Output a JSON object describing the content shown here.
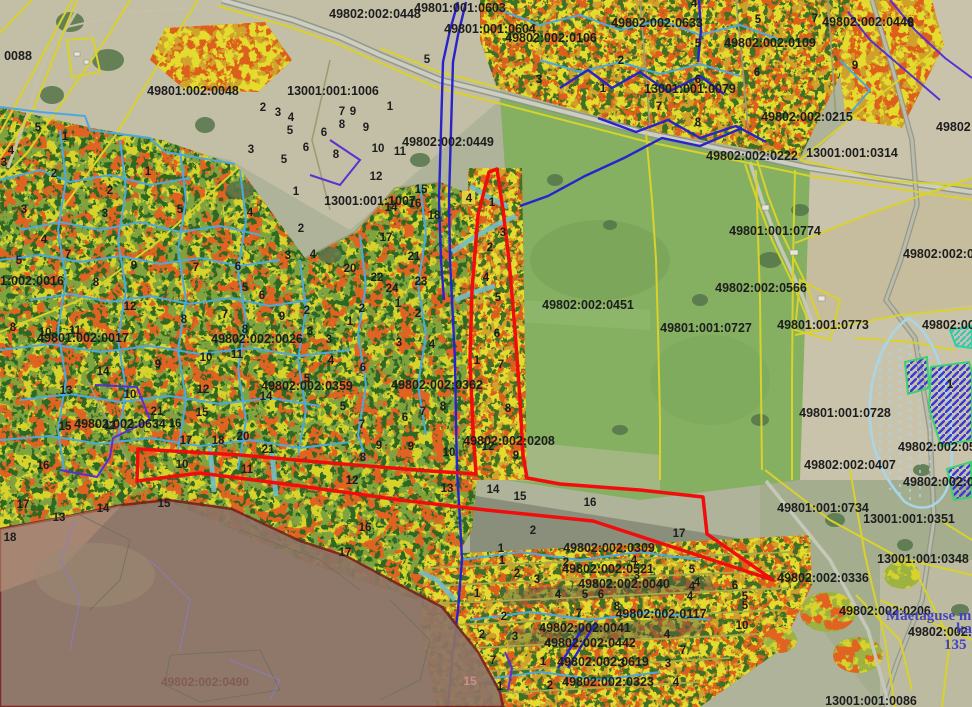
{
  "map": {
    "colors": {
      "selection_red": "#f20d0d",
      "overlay_brown": "#8d7366",
      "overlay_border": "#7a2121",
      "boundary_yellow": "#d8d22b",
      "boundary_cyan": "#4fa8dc",
      "stream_blue": "#2823cc",
      "boundary_purple": "#5b2fd4",
      "hatch_blue": "#3a3ad6",
      "hatch_border_green": "#3fd06f",
      "label_ink": "#1d1d1d",
      "place_blue": "#4343bf"
    },
    "parcel_labels": [
      {
        "t": "49801:001:0603",
        "x": 460,
        "y": 12
      },
      {
        "t": "49802:002:0448",
        "x": 375,
        "y": 18
      },
      {
        "t": "49801:001:0604",
        "x": 490,
        "y": 33
      },
      {
        "t": "49802:002:0106",
        "x": 551,
        "y": 42
      },
      {
        "t": "49802:002:0633",
        "x": 657,
        "y": 27
      },
      {
        "t": "49802:002:0109",
        "x": 770,
        "y": 47
      },
      {
        "t": "49802:002:0446",
        "x": 868,
        "y": 26
      },
      {
        "t": "0088",
        "x": 18,
        "y": 60
      },
      {
        "t": "49801:002:0048",
        "x": 193,
        "y": 95
      },
      {
        "t": "13001:001:1006",
        "x": 333,
        "y": 95
      },
      {
        "t": "13001:001:0079",
        "x": 690,
        "y": 93
      },
      {
        "t": "49802:0",
        "x": 936,
        "y": 131,
        "a": "s"
      },
      {
        "t": "49802:002:0449",
        "x": 448,
        "y": 146
      },
      {
        "t": "49802:002:0215",
        "x": 807,
        "y": 121
      },
      {
        "t": "13001:001:0314",
        "x": 852,
        "y": 157
      },
      {
        "t": "49802:002:0222",
        "x": 752,
        "y": 160
      },
      {
        "t": "13001:001:1007",
        "x": 370,
        "y": 205
      },
      {
        "t": "49801:001:0774",
        "x": 775,
        "y": 235
      },
      {
        "t": "49802:002:0374",
        "x": 903,
        "y": 258,
        "a": "s"
      },
      {
        "t": "1:002:0016",
        "x": 0,
        "y": 285,
        "a": "s"
      },
      {
        "t": "49801:002:0017",
        "x": 83,
        "y": 342
      },
      {
        "t": "49802:002:0026",
        "x": 257,
        "y": 343
      },
      {
        "t": "49802:002:0451",
        "x": 588,
        "y": 309
      },
      {
        "t": "49802:002:0566",
        "x": 761,
        "y": 292
      },
      {
        "t": "49801:001:0727",
        "x": 706,
        "y": 332
      },
      {
        "t": "49801:001:0773",
        "x": 823,
        "y": 329
      },
      {
        "t": "49802:002:0",
        "x": 922,
        "y": 329,
        "a": "s"
      },
      {
        "t": "49802:002:0359",
        "x": 307,
        "y": 390
      },
      {
        "t": "49802:002:0362",
        "x": 437,
        "y": 389
      },
      {
        "t": "49801:001:0728",
        "x": 845,
        "y": 417
      },
      {
        "t": "49802:002:0634",
        "x": 120,
        "y": 428
      },
      {
        "t": "49802:002:0208",
        "x": 509,
        "y": 445
      },
      {
        "t": "49802:002:0570",
        "x": 898,
        "y": 451,
        "a": "s"
      },
      {
        "t": "49802:002:0407",
        "x": 850,
        "y": 469
      },
      {
        "t": "49802:002:0222",
        "x": 903,
        "y": 486,
        "a": "s"
      },
      {
        "t": "49801:001:0734",
        "x": 823,
        "y": 512
      },
      {
        "t": "13001:001:0351",
        "x": 909,
        "y": 523
      },
      {
        "t": "13001:001:0348",
        "x": 923,
        "y": 563
      },
      {
        "t": "49802:002:0336",
        "x": 823,
        "y": 582
      },
      {
        "t": "49802:002:0309",
        "x": 609,
        "y": 552
      },
      {
        "t": "49802:002:0521",
        "x": 608,
        "y": 573
      },
      {
        "t": "49802:002:0040",
        "x": 624,
        "y": 588
      },
      {
        "t": "49802:002:0117",
        "x": 661,
        "y": 618
      },
      {
        "t": "49802:002:0041",
        "x": 585,
        "y": 632
      },
      {
        "t": "49802:002:0442",
        "x": 590,
        "y": 647
      },
      {
        "t": "49802:002:0619",
        "x": 603,
        "y": 666
      },
      {
        "t": "49802:002:0323",
        "x": 608,
        "y": 686
      },
      {
        "t": "49802:002:0206",
        "x": 885,
        "y": 615
      },
      {
        "t": "49802:002:020",
        "x": 908,
        "y": 636,
        "a": "s"
      },
      {
        "t": "13001:001:0086",
        "x": 871,
        "y": 705
      }
    ],
    "overlay_label": {
      "t": "49802:002:0490",
      "x": 205,
      "y": 686
    },
    "pink_label": {
      "t": "15",
      "x": 470,
      "y": 685
    },
    "marker_box": {
      "t": "4",
      "x": 469,
      "y": 202
    },
    "place_text": [
      {
        "t": "Mäetaguse m",
        "x": 886,
        "y": 620,
        "a": "s"
      },
      {
        "t": "ka",
        "x": 956,
        "y": 633,
        "a": "s"
      },
      {
        "t": "135",
        "x": 944,
        "y": 649,
        "a": "s"
      }
    ],
    "unit_numbers": [
      [
        38,
        131,
        "5"
      ],
      [
        65,
        140,
        "1"
      ],
      [
        11,
        154,
        "4"
      ],
      [
        4,
        166,
        "3"
      ],
      [
        54,
        177,
        "2"
      ],
      [
        110,
        194,
        "2"
      ],
      [
        24,
        213,
        "3"
      ],
      [
        105,
        217,
        "3"
      ],
      [
        180,
        213,
        "5"
      ],
      [
        148,
        175,
        "1"
      ],
      [
        250,
        216,
        "4"
      ],
      [
        296,
        195,
        "1"
      ],
      [
        301,
        232,
        "2"
      ],
      [
        263,
        111,
        "2"
      ],
      [
        278,
        116,
        "3"
      ],
      [
        291,
        121,
        "4"
      ],
      [
        290,
        134,
        "5"
      ],
      [
        251,
        153,
        "3"
      ],
      [
        284,
        163,
        "5"
      ],
      [
        306,
        151,
        "6"
      ],
      [
        324,
        136,
        "6"
      ],
      [
        342,
        128,
        "8"
      ],
      [
        336,
        158,
        "8"
      ],
      [
        342,
        115,
        "7"
      ],
      [
        353,
        115,
        "9"
      ],
      [
        366,
        131,
        "9"
      ],
      [
        378,
        152,
        "10"
      ],
      [
        400,
        155,
        "11"
      ],
      [
        376,
        180,
        "12"
      ],
      [
        390,
        110,
        "1"
      ],
      [
        421,
        193,
        "15"
      ],
      [
        415,
        207,
        "16"
      ],
      [
        391,
        211,
        "14"
      ],
      [
        386,
        241,
        "17"
      ],
      [
        434,
        219,
        "18"
      ],
      [
        427,
        63,
        "5"
      ],
      [
        694,
        7,
        "4"
      ],
      [
        758,
        23,
        "5"
      ],
      [
        815,
        22,
        "7"
      ],
      [
        911,
        27,
        "8"
      ],
      [
        539,
        83,
        "3"
      ],
      [
        621,
        64,
        "2"
      ],
      [
        603,
        92,
        "1"
      ],
      [
        698,
        47,
        "5"
      ],
      [
        698,
        83,
        "6"
      ],
      [
        757,
        76,
        "6"
      ],
      [
        659,
        110,
        "7"
      ],
      [
        698,
        126,
        "8"
      ],
      [
        855,
        69,
        "9"
      ],
      [
        19,
        264,
        "5"
      ],
      [
        44,
        243,
        "4"
      ],
      [
        68,
        258,
        "7"
      ],
      [
        134,
        269,
        "9"
      ],
      [
        96,
        286,
        "8"
      ],
      [
        196,
        271,
        "7"
      ],
      [
        238,
        270,
        "6"
      ],
      [
        288,
        259,
        "3"
      ],
      [
        313,
        258,
        "4"
      ],
      [
        245,
        291,
        "5"
      ],
      [
        262,
        299,
        "6"
      ],
      [
        130,
        310,
        "12"
      ],
      [
        184,
        323,
        "8"
      ],
      [
        225,
        318,
        "7"
      ],
      [
        282,
        320,
        "9"
      ],
      [
        13,
        331,
        "8"
      ],
      [
        45,
        336,
        "10"
      ],
      [
        75,
        334,
        "11"
      ],
      [
        245,
        333,
        "8"
      ],
      [
        307,
        314,
        "2"
      ],
      [
        310,
        335,
        "3"
      ],
      [
        329,
        343,
        "3"
      ],
      [
        362,
        312,
        "2"
      ],
      [
        350,
        325,
        "1"
      ],
      [
        398,
        307,
        "1"
      ],
      [
        418,
        317,
        "2"
      ],
      [
        432,
        348,
        "4"
      ],
      [
        350,
        272,
        "20"
      ],
      [
        414,
        260,
        "21"
      ],
      [
        377,
        281,
        "22"
      ],
      [
        421,
        285,
        "23"
      ],
      [
        392,
        292,
        "24"
      ],
      [
        158,
        368,
        "9"
      ],
      [
        237,
        358,
        "11"
      ],
      [
        206,
        361,
        "10"
      ],
      [
        203,
        393,
        "12"
      ],
      [
        103,
        375,
        "14"
      ],
      [
        266,
        400,
        "14"
      ],
      [
        66,
        394,
        "13"
      ],
      [
        130,
        398,
        "10"
      ],
      [
        202,
        416,
        "15"
      ],
      [
        157,
        415,
        "21"
      ],
      [
        175,
        427,
        "16"
      ],
      [
        186,
        444,
        "17"
      ],
      [
        218,
        444,
        "18"
      ],
      [
        243,
        440,
        "20"
      ],
      [
        268,
        453,
        "21"
      ],
      [
        65,
        430,
        "15"
      ],
      [
        110,
        429,
        "11"
      ],
      [
        43,
        469,
        "16"
      ],
      [
        343,
        410,
        "5"
      ],
      [
        362,
        428,
        "7"
      ],
      [
        423,
        415,
        "7"
      ],
      [
        405,
        421,
        "6"
      ],
      [
        443,
        410,
        "8"
      ],
      [
        399,
        346,
        "3"
      ],
      [
        363,
        371,
        "6"
      ],
      [
        331,
        364,
        "4"
      ],
      [
        307,
        382,
        "5"
      ],
      [
        379,
        449,
        "9"
      ],
      [
        411,
        450,
        "9"
      ],
      [
        449,
        456,
        "10"
      ],
      [
        363,
        461,
        "8"
      ],
      [
        477,
        364,
        "1"
      ],
      [
        488,
        450,
        "12"
      ],
      [
        492,
        206,
        "1"
      ],
      [
        503,
        236,
        "3"
      ],
      [
        490,
        251,
        "2"
      ],
      [
        486,
        281,
        "4"
      ],
      [
        498,
        301,
        "5"
      ],
      [
        497,
        337,
        "6"
      ],
      [
        501,
        368,
        "7"
      ],
      [
        508,
        412,
        "8"
      ],
      [
        516,
        459,
        "9"
      ],
      [
        182,
        468,
        "10"
      ],
      [
        247,
        473,
        "11"
      ],
      [
        447,
        492,
        "13"
      ],
      [
        493,
        493,
        "14"
      ],
      [
        520,
        500,
        "15"
      ],
      [
        590,
        506,
        "16"
      ],
      [
        679,
        537,
        "17"
      ],
      [
        23,
        508,
        "17"
      ],
      [
        59,
        521,
        "13"
      ],
      [
        103,
        512,
        "14"
      ],
      [
        164,
        507,
        "15"
      ],
      [
        10,
        541,
        "18"
      ],
      [
        352,
        484,
        "12"
      ],
      [
        365,
        531,
        "16"
      ],
      [
        345,
        556,
        "17"
      ],
      [
        533,
        534,
        "2"
      ],
      [
        501,
        552,
        "1"
      ],
      [
        502,
        564,
        "1"
      ],
      [
        517,
        577,
        "2"
      ],
      [
        537,
        583,
        "3"
      ],
      [
        566,
        566,
        "2"
      ],
      [
        637,
        579,
        "3"
      ],
      [
        634,
        564,
        "4"
      ],
      [
        692,
        573,
        "5"
      ],
      [
        558,
        598,
        "4"
      ],
      [
        585,
        598,
        "5"
      ],
      [
        601,
        598,
        "6"
      ],
      [
        692,
        590,
        "4"
      ],
      [
        690,
        600,
        "4"
      ],
      [
        617,
        610,
        "8"
      ],
      [
        579,
        617,
        "7"
      ],
      [
        745,
        600,
        "5"
      ],
      [
        745,
        609,
        "5"
      ],
      [
        735,
        589,
        "6"
      ],
      [
        742,
        629,
        "10"
      ],
      [
        504,
        620,
        "2"
      ],
      [
        477,
        597,
        "1"
      ],
      [
        482,
        638,
        "2"
      ],
      [
        515,
        640,
        "3"
      ],
      [
        548,
        647,
        "4"
      ],
      [
        667,
        638,
        "4"
      ],
      [
        683,
        654,
        "7"
      ],
      [
        493,
        664,
        "7"
      ],
      [
        543,
        665,
        "1"
      ],
      [
        668,
        667,
        "3"
      ],
      [
        622,
        667,
        "3"
      ],
      [
        500,
        690,
        "1"
      ],
      [
        550,
        689,
        "2"
      ],
      [
        676,
        686,
        "4"
      ],
      [
        697,
        586,
        "4"
      ],
      [
        950,
        388,
        "1"
      ]
    ]
  }
}
